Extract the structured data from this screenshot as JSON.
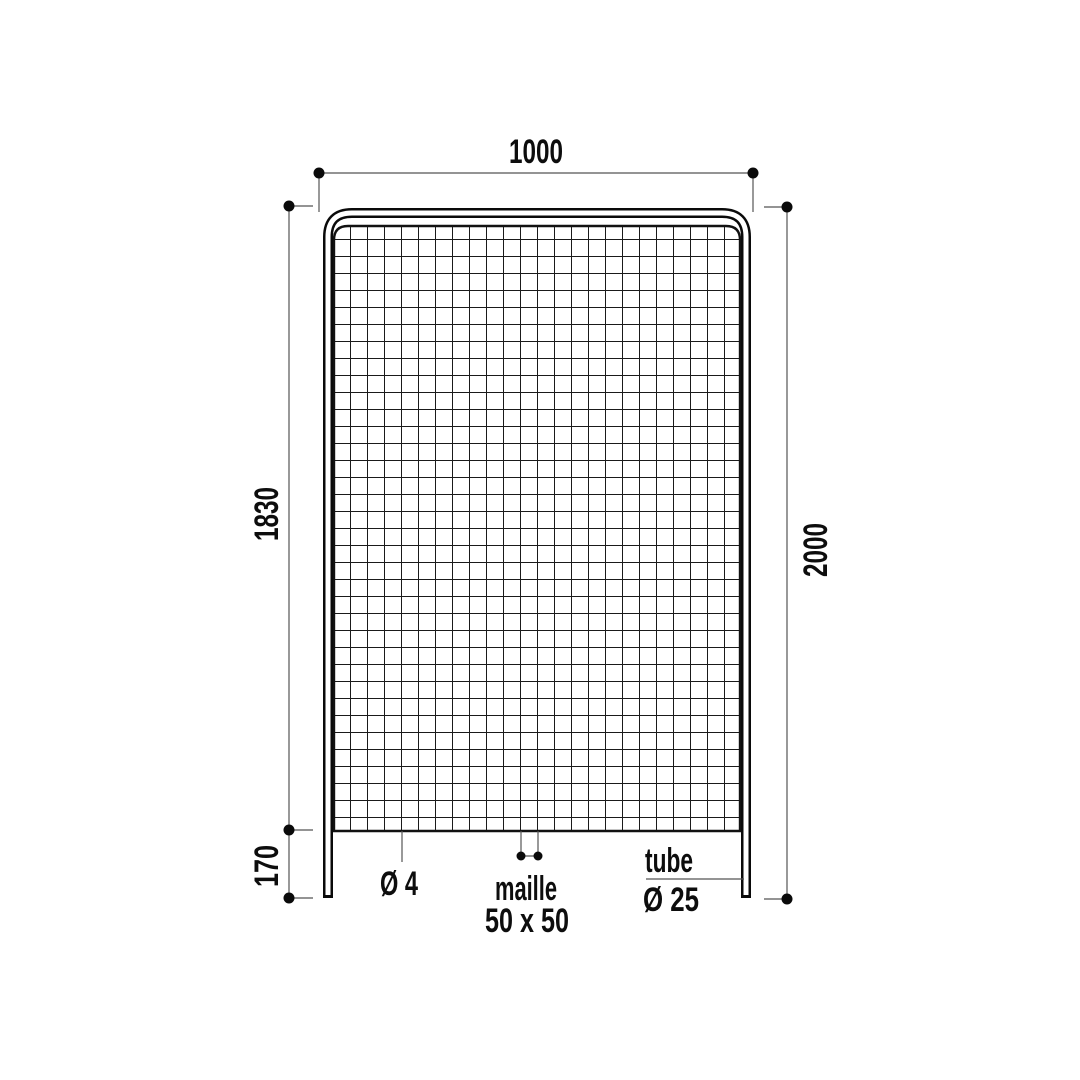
{
  "diagram": {
    "type": "technical-drawing",
    "subject": "wire-mesh fence panel front view",
    "dimensions": {
      "width": "1000",
      "mesh_height": "1830",
      "total_height": "2000",
      "leg_height": "170"
    },
    "annotations": {
      "wire_diameter": "Ø 4",
      "mesh_label": "maille",
      "mesh_size": "50 x 50",
      "tube_label": "tube",
      "tube_diameter": "Ø 25"
    },
    "colors": {
      "background": "#ffffff",
      "drawing_line": "#0d0d0d",
      "dimension_line": "#555555"
    },
    "mesh": {
      "cell_px": 17,
      "columns": 24,
      "rows": 36
    }
  }
}
